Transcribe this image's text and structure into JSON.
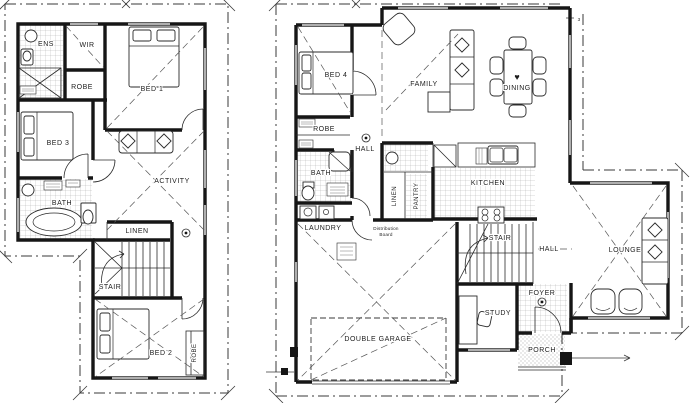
{
  "drawing": {
    "type": "floor-plan",
    "ink": "#161616",
    "paper": "#ffffff"
  },
  "upper_floor": {
    "labels": {
      "ens": "ENS",
      "wir": "WIR",
      "bed1": "BED 1",
      "robe_wir": "ROBE",
      "bed3": "BED 3",
      "activity": "ACTIVITY",
      "bath": "BATH",
      "linen": "LINEN",
      "stair": "STAIR",
      "bed2": "BED 2",
      "robe_bed2": "ROBE"
    }
  },
  "ground_floor": {
    "labels": {
      "bed4": "BED 4",
      "robe_bed4": "ROBE",
      "family": "FAMILY",
      "dining": "DINING",
      "dining_heart": "♥",
      "hall_upper": "HALL",
      "bath": "BATH",
      "laundry": "LAUNDRY",
      "linen": "LINEN",
      "pantry": "PANTRY",
      "kitchen": "KITCHEN",
      "stair": "STAIR",
      "hall_lower": "HALL",
      "lounge": "LOUNGE",
      "study": "STUDY",
      "foyer": "FOYER",
      "porch": "PORCH",
      "garage": "DOUBLE GARAGE"
    },
    "annotations": {
      "distribution_board": [
        "Distribution",
        "Board"
      ],
      "dim_right_top": "3"
    }
  }
}
